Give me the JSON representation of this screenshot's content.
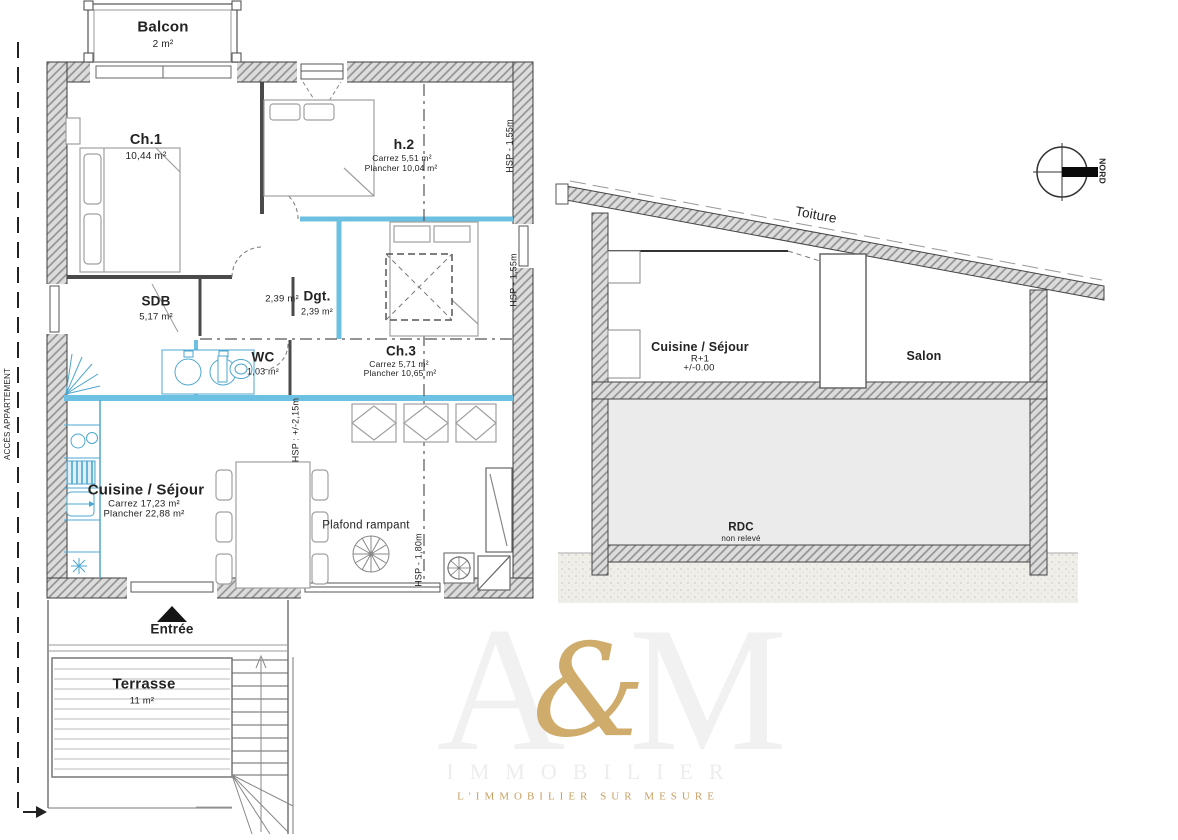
{
  "colors": {
    "partition_blue": "#6cc0e2",
    "fixture_blue": "#4da7cf",
    "wall_gray": "#dcdcdc",
    "hatch_line": "#8f8f8f",
    "gold": "#c9a25e",
    "watermark_gray": "#f1f1f1"
  },
  "floor_plan": {
    "balcon": {
      "name": "Balcon",
      "area": "2 m²"
    },
    "ch1": {
      "name": "Ch.1",
      "area": "10,44 m²"
    },
    "h2": {
      "name": "h.2",
      "carrez": "Carrez 5,51 m²",
      "plancher": "Plancher 10,04 m²"
    },
    "sdb": {
      "name": "SDB",
      "area": "5,17 m²"
    },
    "dgt": {
      "name": "Dgt.",
      "area": "2,39 m²",
      "area_left": "2,39 m²"
    },
    "wc": {
      "name": "WC",
      "area": "1,03 m²"
    },
    "ch3": {
      "name": "Ch.3",
      "carrez": "Carrez 5,71 m²",
      "plancher": "Plancher 10,65 m²"
    },
    "cuisine_sejour": {
      "name": "Cuisine / Séjour",
      "carrez": "Carrez 17,23 m²",
      "plancher": "Plancher 22,88 m²"
    },
    "plafond_rampant": "Plafond rampant",
    "hsp_h2": "HSP - 1,55m",
    "hsp_ch3": "HSP - 1,55m",
    "hsp_sejour": "HSP : +/-2,15m",
    "hsp_bas": "HSP - 1,80m",
    "entree": "Entrée",
    "terrasse": {
      "name": "Terrasse",
      "area": "11 m²"
    },
    "acces": "ACCÈS APPARTEMENT"
  },
  "section": {
    "toiture": "Toiture",
    "cuisine_sejour": "Cuisine / Séjour",
    "niveau": "R+1",
    "cote": "+/-0.00",
    "salon": "Salon",
    "rdc": "RDC",
    "rdc_note": "non relevé"
  },
  "compass": {
    "label": "NORD"
  },
  "watermark": {
    "letter_a": "A",
    "ampersand": "&",
    "letter_m": "M",
    "brand": "IMMOBILIER",
    "tagline": "L'IMMOBILIER SUR MESURE"
  }
}
